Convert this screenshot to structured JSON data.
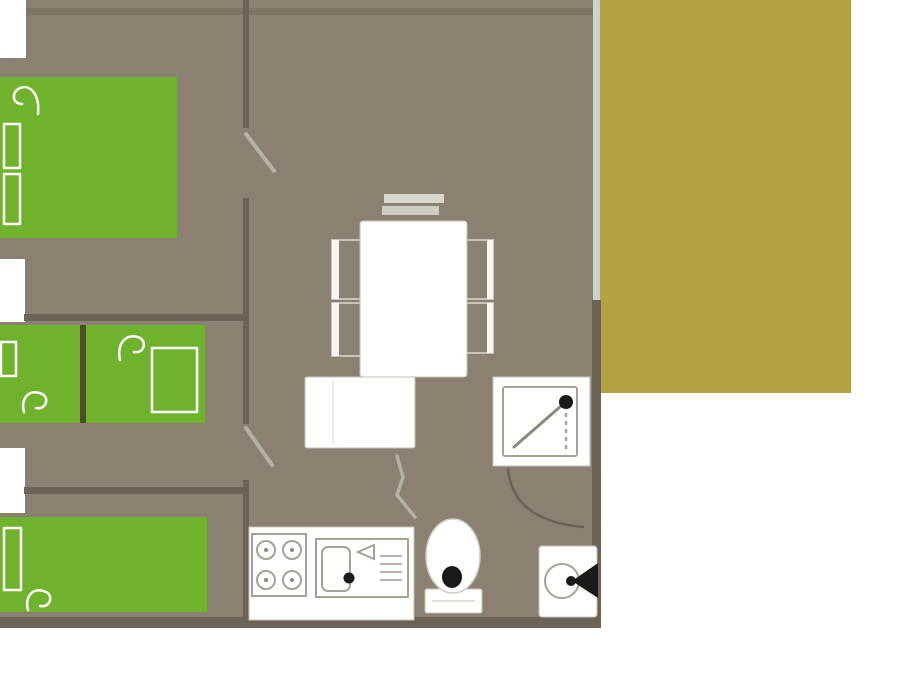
{
  "plan": {
    "kind": "floor-plan",
    "areas": [
      {
        "name": "bedroom-top",
        "furniture": [
          "double-bed"
        ]
      },
      {
        "name": "bedroom-middle",
        "furniture": [
          "bunk-bed-left",
          "bunk-bed-right"
        ]
      },
      {
        "name": "bedroom-bottom",
        "furniture": [
          "double-bed"
        ]
      },
      {
        "name": "living-dining",
        "furniture": [
          "bench",
          "dining-table",
          "chairs-left",
          "chairs-right",
          "sofa-unit"
        ]
      },
      {
        "name": "kitchen",
        "furniture": [
          "stove-4-burners",
          "sink-with-drainer"
        ]
      },
      {
        "name": "bathroom",
        "furniture": [
          "shower",
          "toilet",
          "washbasin"
        ]
      },
      {
        "name": "terrace",
        "furniture": []
      }
    ],
    "doors": [
      "bedroom-top-door",
      "bedroom-middle-door",
      "bathroom-door",
      "bathroom-door-swing"
    ],
    "windows": [
      "left-window-1",
      "left-window-2",
      "left-window-3",
      "terrace-glass-wall"
    ]
  },
  "colors": {
    "floor": "#8a8172",
    "wall": "#6b6355",
    "bed_green": "#6fb32c",
    "bunk_divider": "#4c5028",
    "terrace": "#b2a241",
    "glass": "#c9d3d6",
    "white": "#ffffff",
    "outline_light": "#c7c3b6",
    "outline_mid": "#a5a194",
    "door_leaf": "#b6b1a5",
    "black": "#1a1a1a"
  }
}
